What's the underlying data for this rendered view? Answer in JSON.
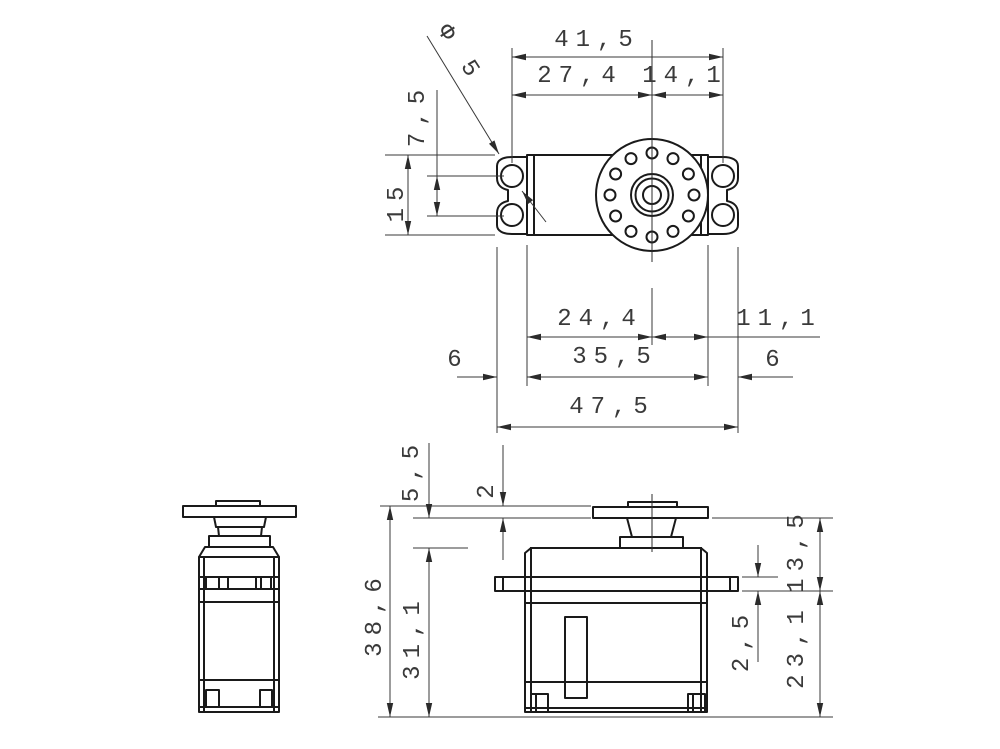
{
  "drawing": {
    "kind": "servo motor dimension drawing",
    "background_color": "#ffffff",
    "object_line_color": "#1a1a1a",
    "dimension_line_color": "#383838",
    "text_color": "#3a3a3a"
  },
  "top_view": {
    "dims": {
      "d41_5": "41,5",
      "d27_4": "27,4",
      "d14_1": "14,1",
      "dphi": "Φ 5",
      "d7_5": "7,5",
      "d15": "15",
      "d24_4": "24,4",
      "d11_1": "11,1",
      "d6_left": "6",
      "d35_5": "35,5",
      "d6_right": "6",
      "d47_5": "47,5"
    }
  },
  "front_view": {
    "dims": {
      "d5_5": "5,5",
      "d2": "2",
      "d38_6": "38,6",
      "d31_1": "31,1",
      "d13_5": "13,5",
      "d2_5": "2,5",
      "d23_1": "23,1"
    }
  }
}
